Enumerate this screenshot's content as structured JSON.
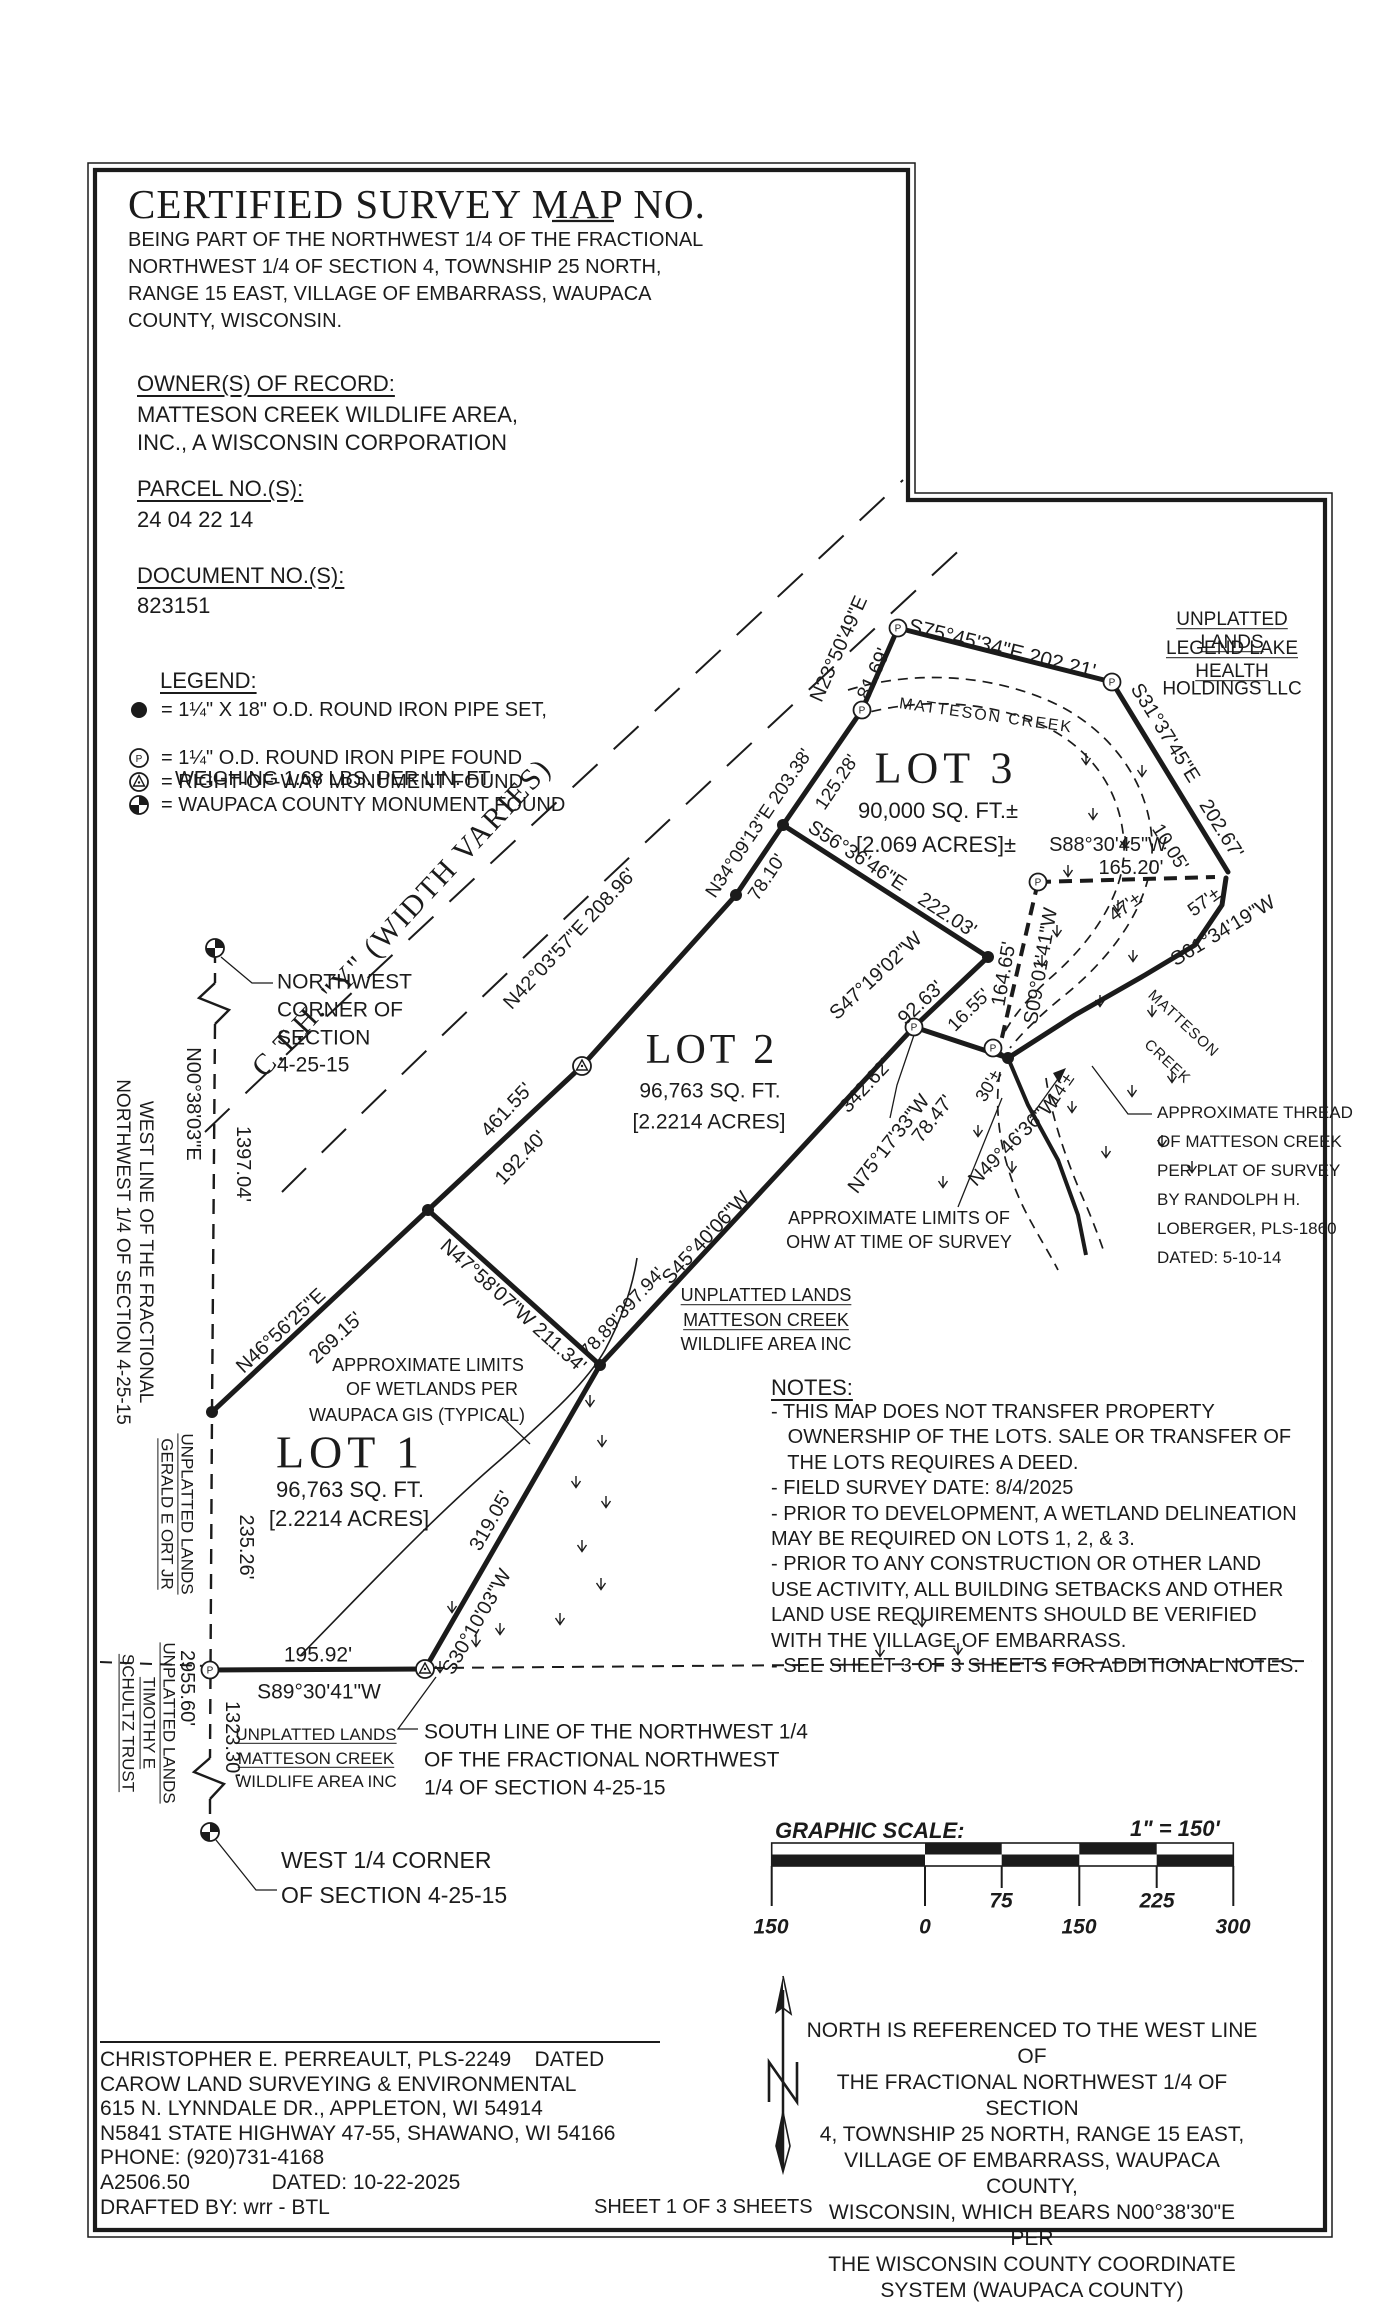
{
  "header": {
    "title": "CERTIFIED SURVEY MAP NO.",
    "subtitle_lines": [
      "BEING PART OF THE NORTHWEST 1/4 OF THE FRACTIONAL",
      "NORTHWEST 1/4 OF SECTION 4, TOWNSHIP 25 NORTH,",
      "RANGE 15 EAST, VILLAGE OF EMBARRASS, WAUPACA",
      "COUNTY, WISCONSIN."
    ]
  },
  "owner": {
    "heading": "OWNER(S) OF RECORD:",
    "lines": [
      "MATTESON CREEK WILDLIFE AREA,",
      "INC., A WISCONSIN CORPORATION"
    ]
  },
  "parcel": {
    "heading": "PARCEL NO.(S):",
    "value": "24 04 22 14"
  },
  "doc": {
    "heading": "DOCUMENT NO.(S):",
    "value": "823151"
  },
  "legend": {
    "heading": "LEGEND:",
    "items": [
      {
        "symbol": "iron-pipe-set-icon",
        "text": "= 1¼\" X 18\" O.D. ROUND IRON PIPE SET,",
        "text2": "WEIGHING 1.68 LBS. PER LIN. FT."
      },
      {
        "symbol": "iron-pipe-found-icon",
        "text": "= 1¼\" O.D. ROUND IRON PIPE FOUND"
      },
      {
        "symbol": "row-monument-icon",
        "text": "= RIGHT-OF-WAY MONUMENT FOUND"
      },
      {
        "symbol": "county-monument-icon",
        "text": "= WAUPACA COUNTY MONUMENT FOUND"
      }
    ]
  },
  "notes": {
    "heading": "NOTES:",
    "lines": [
      "- THIS MAP DOES NOT TRANSFER PROPERTY",
      "   OWNERSHIP OF THE LOTS. SALE OR TRANSFER OF",
      "   THE LOTS REQUIRES A DEED.",
      "- FIELD SURVEY DATE: 8/4/2025",
      "- PRIOR TO DEVELOPMENT, A WETLAND DELINEATION",
      "MAY BE REQUIRED ON LOTS 1, 2, & 3.",
      "- PRIOR TO ANY CONSTRUCTION OR OTHER LAND",
      "USE ACTIVITY, ALL BUILDING SETBACKS AND OTHER",
      "LAND USE REQUIREMENTS SHOULD BE VERIFIED",
      "WITH THE VILLAGE OF EMBARRASS.",
      "- SEE SHEET 3 OF 3 SHEETS FOR ADDITIONAL NOTES."
    ]
  },
  "scale": {
    "heading": "GRAPHIC SCALE:",
    "ratio": "1\" = 150'",
    "ticks": [
      "150",
      "0",
      "75",
      "150",
      "225",
      "300"
    ]
  },
  "north_note": {
    "lines": [
      "NORTH IS REFERENCED TO THE WEST LINE OF",
      "THE FRACTIONAL NORTHWEST 1/4 OF SECTION",
      "4, TOWNSHIP 25 NORTH, RANGE 15 EAST,",
      "VILLAGE OF EMBARRASS, WAUPACA COUNTY,",
      "WISCONSIN, WHICH BEARS N00°38'30\"E PER",
      "THE WISCONSIN COUNTY COORDINATE",
      "SYSTEM (WAUPACA COUNTY)"
    ]
  },
  "surveyor": {
    "lines": [
      "CHRISTOPHER E. PERREAULT, PLS-2249    DATED",
      "CAROW LAND SURVEYING & ENVIRONMENTAL",
      "615 N. LYNNDALE DR., APPLETON, WI 54914",
      "N5841 STATE HIGHWAY 47-55, SHAWANO, WI 54166",
      "PHONE: (920)731-4168",
      "A2506.50              DATED: 10-22-2025",
      "DRAFTED BY: wrr - BTL"
    ]
  },
  "sheet_label": "SHEET 1 OF 3 SHEETS",
  "colors": {
    "ink": "#1b1b1b",
    "paper": "#ffffff"
  },
  "map_labels": [
    {
      "t": "UNPLATTED LANDS",
      "x": 1232,
      "y": 632,
      "s": 19,
      "u": 1
    },
    {
      "t": "LEGEND LAKE HEALTH",
      "x": 1232,
      "y": 661,
      "s": 19,
      "u": 1
    },
    {
      "t": "HOLDINGS LLC",
      "x": 1232,
      "y": 690,
      "s": 19
    },
    {
      "t": "N23°50'49\"E",
      "x": 839,
      "y": 649,
      "r": -66,
      "s": 20
    },
    {
      "t": "81.69'",
      "x": 874,
      "y": 674,
      "r": -66,
      "s": 20
    },
    {
      "t": "S75°45'34\"E  202.21'",
      "x": 1002,
      "y": 649,
      "r": 14,
      "s": 21
    },
    {
      "t": "MATTESON CREEK",
      "x": 986,
      "y": 716,
      "r": 8,
      "s": 16,
      "ls": 2
    },
    {
      "t": "LOT 3",
      "x": 946,
      "y": 769,
      "s": 44,
      "f": 1,
      "ls": 5
    },
    {
      "t": "90,000 SQ. FT.±",
      "x": 938,
      "y": 811,
      "s": 22
    },
    {
      "t": "[2.069 ACRES]±",
      "x": 936,
      "y": 845,
      "s": 22
    },
    {
      "t": "S31°37'45\"E",
      "x": 1165,
      "y": 733,
      "r": 58,
      "s": 20
    },
    {
      "t": "202.67'",
      "x": 1221,
      "y": 829,
      "r": 58,
      "s": 20
    },
    {
      "t": "10.05'",
      "x": 1169,
      "y": 848,
      "r": 58,
      "s": 19
    },
    {
      "t": "S88°30'45\"W",
      "x": 1108,
      "y": 845,
      "s": 20
    },
    {
      "t": "165.20'",
      "x": 1131,
      "y": 868,
      "s": 20
    },
    {
      "t": "47'±",
      "x": 1126,
      "y": 908,
      "r": -36,
      "s": 19
    },
    {
      "t": "57'±",
      "x": 1205,
      "y": 903,
      "r": -36,
      "s": 19
    },
    {
      "t": "S61°34'19\"W",
      "x": 1223,
      "y": 931,
      "r": -31,
      "s": 20
    },
    {
      "t": "N34°09'13\"E  203.38'",
      "x": 760,
      "y": 824,
      "r": -56,
      "s": 19
    },
    {
      "t": "125.28'",
      "x": 838,
      "y": 783,
      "r": -56,
      "s": 19
    },
    {
      "t": "78.10'",
      "x": 768,
      "y": 878,
      "r": -56,
      "s": 19
    },
    {
      "t": "S56°36'46\"E",
      "x": 857,
      "y": 856,
      "r": 33,
      "s": 20
    },
    {
      "t": "222.03'",
      "x": 947,
      "y": 915,
      "r": 33,
      "s": 20
    },
    {
      "t": "S09°01'41\"W",
      "x": 1041,
      "y": 966,
      "r": -80,
      "s": 20
    },
    {
      "t": "164.65'",
      "x": 1004,
      "y": 974,
      "r": -80,
      "s": 20
    },
    {
      "t": "S47°19'02\"W",
      "x": 876,
      "y": 976,
      "r": -43,
      "s": 20
    },
    {
      "t": "92.63'",
      "x": 921,
      "y": 1003,
      "r": -43,
      "s": 20
    },
    {
      "t": "16.55'",
      "x": 970,
      "y": 1011,
      "r": -45,
      "s": 19
    },
    {
      "t": "30'±",
      "x": 989,
      "y": 1086,
      "r": -60,
      "s": 18
    },
    {
      "t": "14'±",
      "x": 1061,
      "y": 1089,
      "r": -55,
      "s": 18
    },
    {
      "t": "N49°46'36\"W",
      "x": 1014,
      "y": 1141,
      "r": -45,
      "s": 20
    },
    {
      "t": "N75°17'33\"W",
      "x": 889,
      "y": 1144,
      "r": -52,
      "s": 20
    },
    {
      "t": "78.47'",
      "x": 933,
      "y": 1119,
      "r": -52,
      "s": 20
    },
    {
      "t": "342.62'",
      "x": 866,
      "y": 1086,
      "r": -47,
      "s": 20
    },
    {
      "t": "MATTESON",
      "x": 1183,
      "y": 1024,
      "r": 43,
      "s": 15,
      "ls": 1
    },
    {
      "t": "CREEK",
      "x": 1167,
      "y": 1062,
      "r": 43,
      "s": 15,
      "ls": 1
    },
    {
      "t": "APPROXIMATE THREAD",
      "x": 1157,
      "y": 1113,
      "s": 17,
      "a": "l"
    },
    {
      "t": "OF MATTESON CREEK",
      "x": 1157,
      "y": 1142,
      "s": 17,
      "a": "l"
    },
    {
      "t": "PER PLAT OF SURVEY",
      "x": 1157,
      "y": 1171,
      "s": 17,
      "a": "l"
    },
    {
      "t": "BY RANDOLPH H.",
      "x": 1157,
      "y": 1200,
      "s": 17,
      "a": "l"
    },
    {
      "t": "LOBERGER, PLS-1860",
      "x": 1157,
      "y": 1229,
      "s": 17,
      "a": "l"
    },
    {
      "t": "DATED: 5-10-14",
      "x": 1157,
      "y": 1258,
      "s": 17,
      "a": "l"
    },
    {
      "t": "APPROXIMATE LIMITS OF",
      "x": 899,
      "y": 1219,
      "s": 18
    },
    {
      "t": "OHW AT TIME OF SURVEY",
      "x": 899,
      "y": 1243,
      "s": 18
    },
    {
      "t": "LOT 2",
      "x": 712,
      "y": 1050,
      "s": 42,
      "f": 1,
      "ls": 4
    },
    {
      "t": "96,763 SQ. FT.",
      "x": 710,
      "y": 1091,
      "s": 21
    },
    {
      "t": "[2.2214 ACRES]",
      "x": 709,
      "y": 1122,
      "s": 21
    },
    {
      "t": "N42°03'57\"E  208.96'",
      "x": 570,
      "y": 939,
      "r": -47,
      "s": 20
    },
    {
      "t": "C.T.H. \"Y\" (WIDTH VARIES)",
      "x": 402,
      "y": 918,
      "r": -47,
      "s": 30,
      "f": 1,
      "ls": 2
    },
    {
      "t": "461.55'",
      "x": 507,
      "y": 1110,
      "r": -47,
      "s": 20
    },
    {
      "t": "192.40'",
      "x": 521,
      "y": 1158,
      "r": -47,
      "s": 20
    },
    {
      "t": "NORTHWEST",
      "x": 277,
      "y": 982,
      "s": 21,
      "a": "l"
    },
    {
      "t": "CORNER OF",
      "x": 277,
      "y": 1010,
      "s": 21,
      "a": "l"
    },
    {
      "t": "SECTION",
      "x": 277,
      "y": 1038,
      "s": 21,
      "a": "l"
    },
    {
      "t": "4-25-15",
      "x": 277,
      "y": 1065,
      "s": 21,
      "a": "l"
    },
    {
      "t": "N00°38'03\"E",
      "x": 193,
      "y": 1104,
      "r": 90,
      "s": 20
    },
    {
      "t": "1397.04'",
      "x": 243,
      "y": 1164,
      "r": 90,
      "s": 20
    },
    {
      "t": "WEST LINE OF THE FRACTIONAL\nNORTHWEST 1/4 OF SECTION 4-25-15",
      "x": 133,
      "y": 1252,
      "r": 90,
      "s": 19
    },
    {
      "t": "N46°56'25\"E",
      "x": 281,
      "y": 1331,
      "r": -43,
      "s": 20
    },
    {
      "t": "269.15'",
      "x": 336,
      "y": 1338,
      "r": -43,
      "s": 20
    },
    {
      "t": "N47°58'07\"W  211.34'",
      "x": 513,
      "y": 1306,
      "r": 42,
      "s": 20
    },
    {
      "t": "78.89'",
      "x": 602,
      "y": 1337,
      "r": -47,
      "s": 19
    },
    {
      "t": "397.94'",
      "x": 641,
      "y": 1294,
      "r": -47,
      "s": 19
    },
    {
      "t": "S45°40'06\"W",
      "x": 706,
      "y": 1238,
      "r": -47,
      "s": 20
    },
    {
      "t": "UNPLATTED LANDS",
      "x": 766,
      "y": 1296,
      "s": 18,
      "u": 1
    },
    {
      "t": "MATTESON CREEK",
      "x": 766,
      "y": 1321,
      "s": 18,
      "u": 1
    },
    {
      "t": "WILDLIFE AREA INC",
      "x": 766,
      "y": 1345,
      "s": 18
    },
    {
      "t": "APPROXIMATE LIMITS",
      "x": 428,
      "y": 1366,
      "s": 18
    },
    {
      "t": "OF WETLANDS PER",
      "x": 432,
      "y": 1390,
      "s": 18
    },
    {
      "t": "WAUPACA GIS (TYPICAL)",
      "x": 417,
      "y": 1416,
      "s": 18
    },
    {
      "t": "LOT 1",
      "x": 350,
      "y": 1452,
      "s": 46,
      "f": 1,
      "ls": 5
    },
    {
      "t": "96,763 SQ. FT.",
      "x": 350,
      "y": 1490,
      "s": 22
    },
    {
      "t": "[2.2214 ACRES]",
      "x": 349,
      "y": 1519,
      "s": 22
    },
    {
      "t": "235.26'",
      "x": 246,
      "y": 1547,
      "r": 90,
      "s": 20
    },
    {
      "t": "UNPLATTED LANDS\nGERALD E ORT JR",
      "x": 176,
      "y": 1514,
      "r": 90,
      "s": 17,
      "u": 1
    },
    {
      "t": "319.05'",
      "x": 491,
      "y": 1521,
      "r": -60,
      "s": 20
    },
    {
      "t": "S30°10'03\"W",
      "x": 477,
      "y": 1622,
      "r": -60,
      "s": 20
    },
    {
      "t": "2955.60'",
      "x": 187,
      "y": 1688,
      "r": 90,
      "s": 20
    },
    {
      "t": "1323.30'",
      "x": 232,
      "y": 1739,
      "r": 90,
      "s": 20
    },
    {
      "t": "UNPLATTED LANDS\nTIMOTHY E\nSCHULTZ TRUST",
      "x": 148,
      "y": 1723,
      "r": 90,
      "s": 17,
      "u": 1
    },
    {
      "t": "195.92'",
      "x": 318,
      "y": 1655,
      "s": 21
    },
    {
      "t": "S89°30'41\"W",
      "x": 319,
      "y": 1692,
      "s": 21
    },
    {
      "t": "UNPLATTED LANDS",
      "x": 316,
      "y": 1735,
      "s": 17,
      "u": 1
    },
    {
      "t": "MATTESON CREEK",
      "x": 316,
      "y": 1759,
      "s": 17,
      "u": 1
    },
    {
      "t": "WILDLIFE AREA INC",
      "x": 316,
      "y": 1782,
      "s": 17
    },
    {
      "t": "SOUTH LINE OF THE NORTHWEST 1/4",
      "x": 424,
      "y": 1732,
      "s": 21,
      "a": "l"
    },
    {
      "t": "OF THE FRACTIONAL NORTHWEST",
      "x": 424,
      "y": 1760,
      "s": 21,
      "a": "l"
    },
    {
      "t": "1/4 OF SECTION 4-25-15",
      "x": 424,
      "y": 1788,
      "s": 21,
      "a": "l"
    },
    {
      "t": "WEST 1/4 CORNER",
      "x": 281,
      "y": 1861,
      "s": 23,
      "a": "l"
    },
    {
      "t": "OF SECTION 4-25-15",
      "x": 281,
      "y": 1896,
      "s": 23,
      "a": "l"
    }
  ]
}
